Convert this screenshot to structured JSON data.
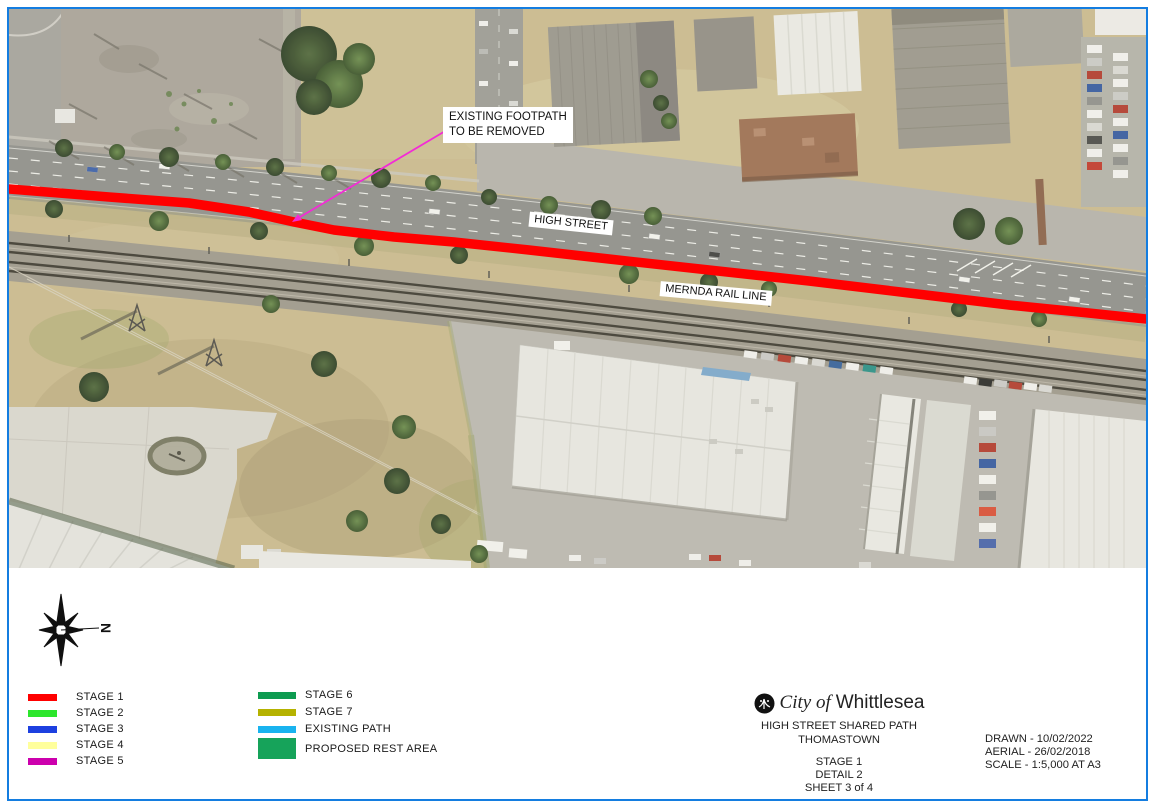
{
  "sheet": {
    "border_color": "#147de0"
  },
  "map": {
    "callout": {
      "line1": "EXISTING FOOTPATH",
      "line2": "TO BE REMOVED"
    },
    "road_label": "HIGH STREET",
    "rail_label": "MERNDA RAIL LINE",
    "stage1_path_color": "#ff0000",
    "callout_arrow_color": "#f32bd6"
  },
  "compass": {
    "north_label": "N"
  },
  "legend": {
    "columns": [
      {
        "items": [
          {
            "label": "STAGE 1",
            "color": "#ff0000"
          },
          {
            "label": "STAGE 2",
            "color": "#2ce62c"
          },
          {
            "label": "STAGE 3",
            "color": "#1d40e0"
          },
          {
            "label": "STAGE 4",
            "color": "#ffff9c"
          },
          {
            "label": "STAGE 5",
            "color": "#cc00ad"
          }
        ]
      },
      {
        "items": [
          {
            "label": "STAGE 6",
            "color": "#0d9b50"
          },
          {
            "label": "STAGE 7",
            "color": "#b5b200"
          },
          {
            "label": "EXISTING PATH",
            "color": "#19b3ef"
          },
          {
            "label": "PROPOSED REST AREA",
            "color": "#16a35a"
          }
        ]
      }
    ]
  },
  "title_block": {
    "agency_prefix": "City of",
    "agency_name": "Whittlesea",
    "project_line1": "HIGH STREET SHARED PATH",
    "project_line2": "THOMASTOWN",
    "stage": "STAGE 1",
    "detail": "DETAIL 2",
    "sheet": "SHEET 3 of 4"
  },
  "meta_block": {
    "drawn": "DRAWN - 10/02/2022",
    "aerial": "AERIAL - 26/02/2018",
    "scale": "SCALE - 1:5,000 AT A3"
  }
}
